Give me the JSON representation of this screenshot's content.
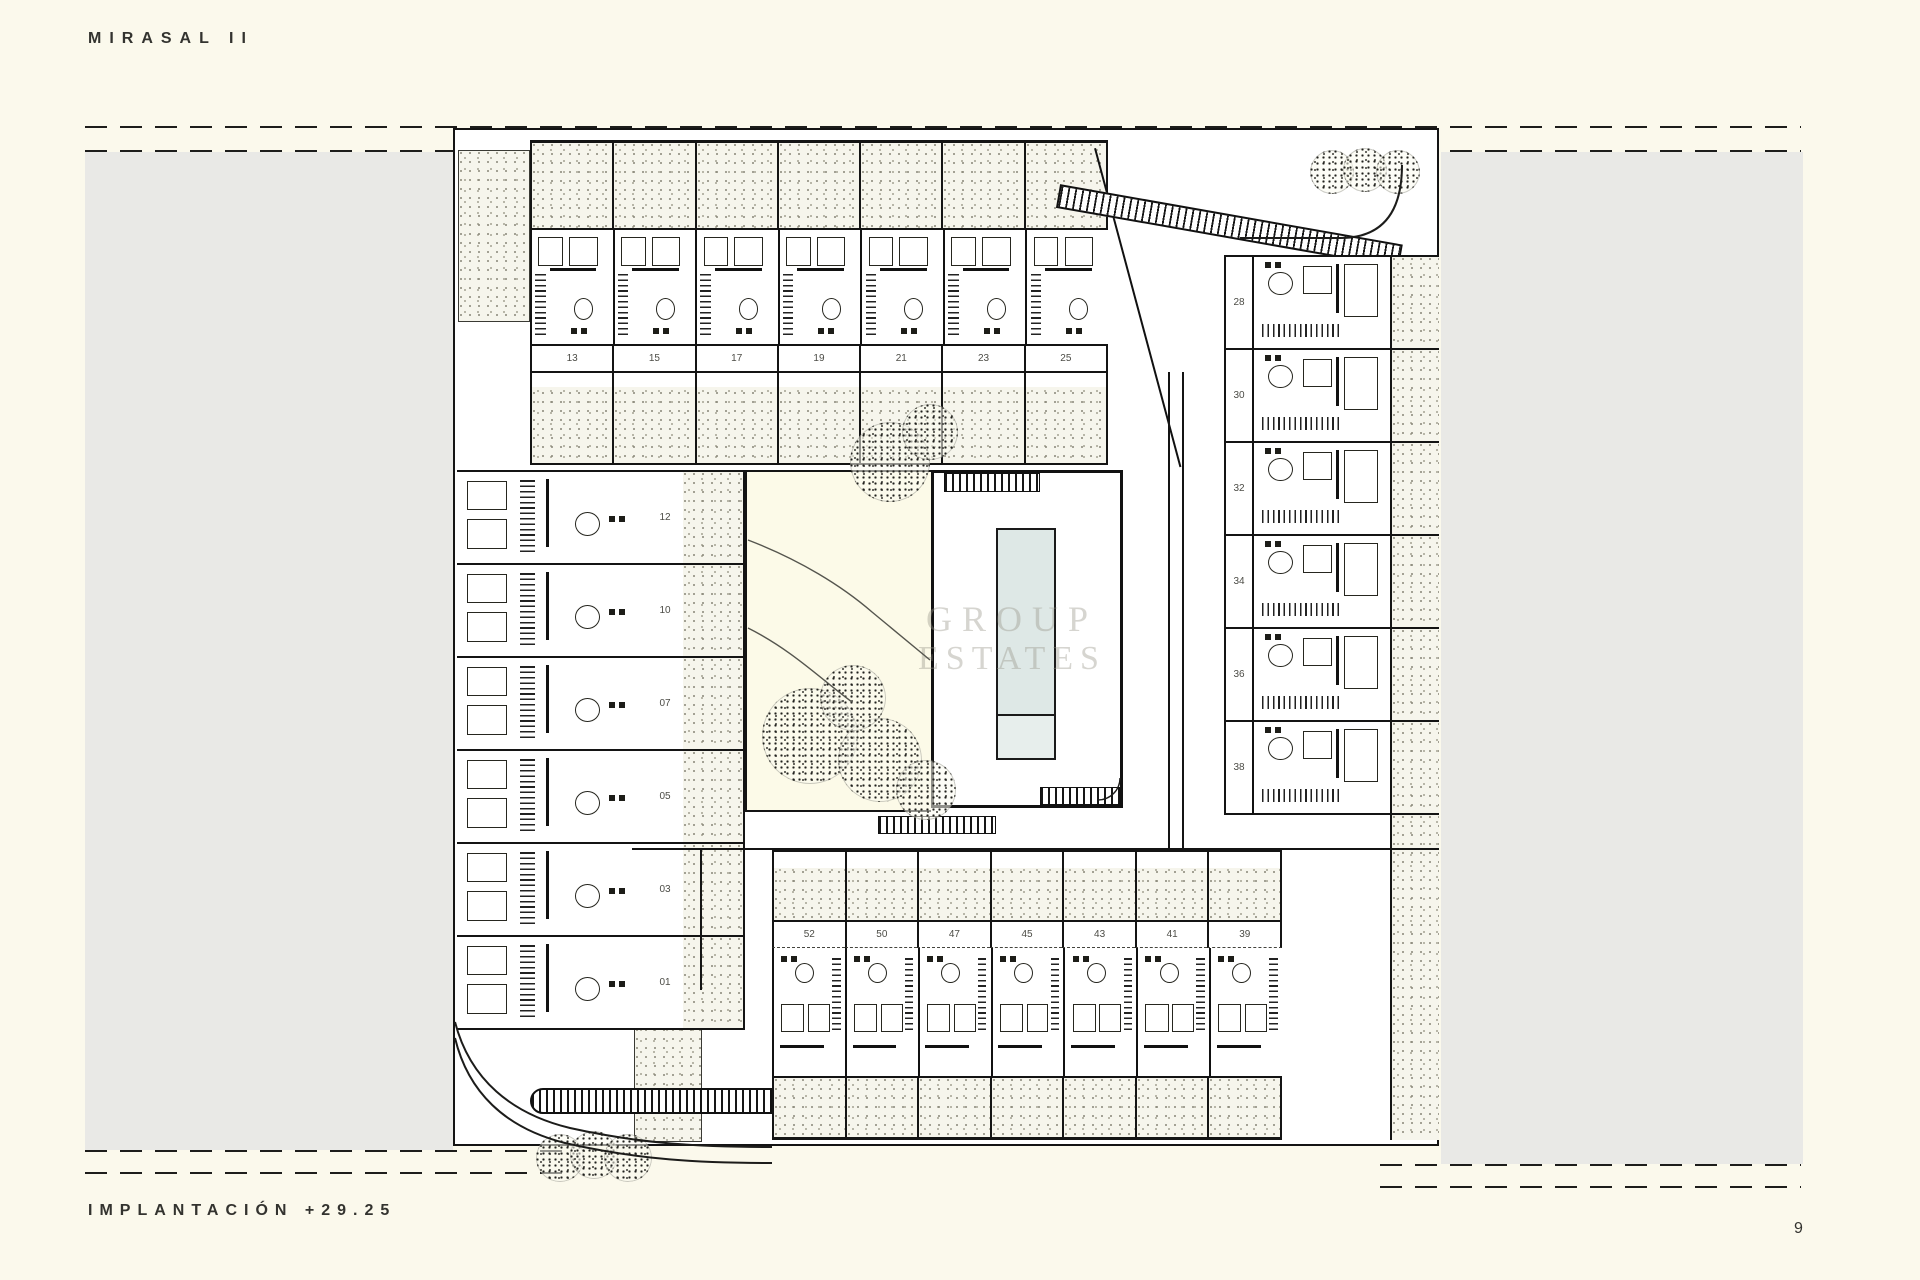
{
  "header": {
    "title": "MIRASAL II"
  },
  "footer": {
    "label": "IMPLANTACIÓN +29.25",
    "page_number": "9"
  },
  "watermark": {
    "line1": "GROUP",
    "line2": "ESTATES"
  },
  "plan": {
    "top_row_units": [
      "13",
      "15",
      "17",
      "19",
      "21",
      "23",
      "25"
    ],
    "left_column_units": [
      "12",
      "10",
      "07",
      "05",
      "03",
      "01"
    ],
    "right_column_units": [
      "28",
      "30",
      "32",
      "34",
      "36",
      "38"
    ],
    "bottom_row_units": [
      "52",
      "50",
      "47",
      "45",
      "43",
      "41",
      "39"
    ],
    "colors": {
      "paper": "#fbf9ec",
      "ground_gray": "#e9e9e6",
      "line_black": "#141414",
      "pool_water": "#dee8e6",
      "patio_stipple": "#f6f5ec"
    }
  }
}
